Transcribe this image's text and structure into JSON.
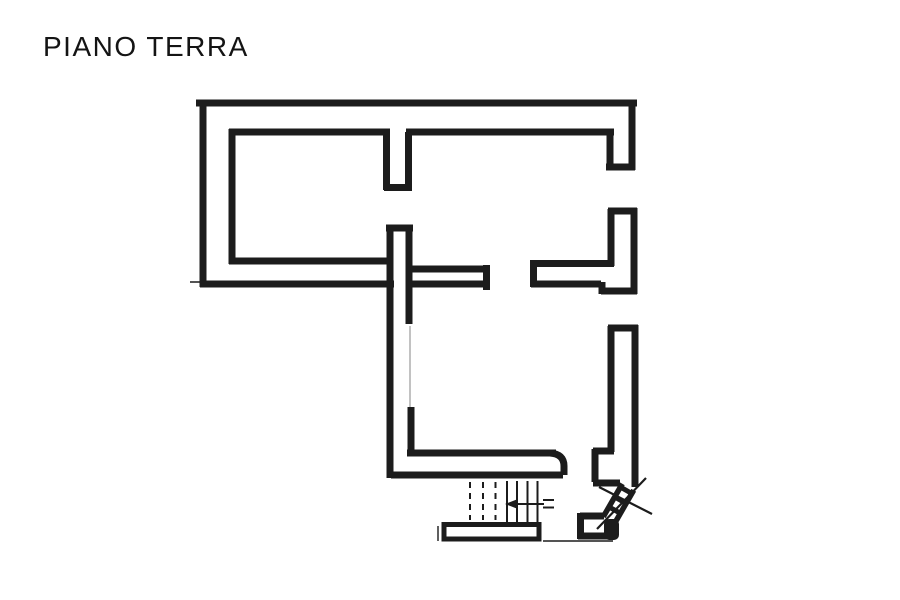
{
  "title": "PIANO TERRA",
  "colors": {
    "ink": "#1c1c1c",
    "paper": "#ffffff",
    "faint": "#b3b3b3"
  },
  "plan": {
    "wall_thickness": 7,
    "walls": [
      [
        196,
        103,
        637,
        103
      ],
      [
        203,
        100,
        203,
        287
      ],
      [
        200,
        284,
        394,
        284
      ],
      [
        632,
        100,
        632,
        170
      ],
      [
        606,
        167,
        635,
        167
      ],
      [
        610,
        129,
        610,
        170
      ],
      [
        229,
        132,
        390,
        132
      ],
      [
        232,
        129,
        232,
        264
      ],
      [
        229,
        261,
        391,
        261
      ],
      [
        406,
        132,
        614,
        132
      ],
      [
        386.5,
        132,
        386.5,
        190
      ],
      [
        408.5,
        132,
        408.5,
        190
      ],
      [
        384,
        187.5,
        412,
        187.5
      ],
      [
        386,
        228,
        413,
        228
      ],
      [
        390,
        228,
        390,
        478
      ],
      [
        409,
        228,
        409,
        324
      ],
      [
        411,
        407,
        411,
        455
      ],
      [
        411,
        269,
        488,
        269
      ],
      [
        409,
        284,
        488,
        284
      ],
      [
        486.5,
        265,
        486.5,
        290
      ],
      [
        533.5,
        260,
        533.5,
        287
      ],
      [
        531,
        263.5,
        614,
        263.5
      ],
      [
        531,
        284,
        601,
        284
      ],
      [
        602,
        282,
        602,
        294
      ],
      [
        608,
        211,
        637,
        211
      ],
      [
        611,
        209,
        611,
        266
      ],
      [
        634,
        208,
        634,
        294
      ],
      [
        601,
        291,
        637,
        291
      ],
      [
        608,
        328,
        638,
        328
      ],
      [
        611,
        326,
        611,
        452
      ],
      [
        635,
        325,
        635,
        487
      ],
      [
        593,
        451,
        614,
        451
      ],
      [
        595,
        449,
        595,
        482
      ],
      [
        593,
        483,
        620,
        483
      ],
      [
        407,
        453,
        556,
        453
      ],
      [
        391,
        475,
        563,
        475
      ],
      [
        580,
        516,
        604,
        516
      ],
      [
        580.5,
        513,
        580.5,
        539
      ],
      [
        578,
        536,
        614,
        536
      ]
    ],
    "wall_paths": [
      {
        "d": "M550,453 Q564,454 564,466 L564,475"
      }
    ],
    "thin_lines": [
      [
        190,
        282,
        245,
        282
      ],
      [
        438,
        526,
        438,
        541
      ],
      [
        543,
        541,
        613,
        541
      ]
    ],
    "faint_lines": [
      [
        410,
        326,
        410,
        407
      ]
    ],
    "stairs": {
      "tread_width": 2,
      "dash_pattern": "6 5",
      "dashed_treads": [
        [
          470,
          482,
          520
        ],
        [
          483,
          482,
          520
        ],
        [
          495.5,
          482,
          520
        ]
      ],
      "solid_treads": [
        [
          507,
          481,
          522
        ],
        [
          517,
          481,
          522
        ],
        [
          527.5,
          481,
          522
        ],
        [
          537.5,
          481,
          522
        ]
      ],
      "arrow": {
        "shaft": [
          516,
          504,
          544,
          504
        ],
        "head_points": "505,504 518,499 518,509",
        "tail_ticks": [
          [
            543,
            500,
            554,
            500
          ],
          [
            543,
            507.5,
            554,
            507.5
          ]
        ]
      },
      "landing": {
        "x": 444,
        "y": 524.5,
        "w": 95,
        "h": 14.5,
        "stroke_w": 5
      }
    },
    "diagonal_stair": {
      "edge_width": 5.5,
      "rung_width": 5,
      "cross_width": 2.2,
      "edges": [
        [
          622.3,
          483.8,
          603.3,
          516.8
        ],
        [
          633.7,
          490.2,
          614.7,
          523.2
        ]
      ],
      "rungs": [
        [
          620.4,
          487.1,
          631.8,
          493.5
        ],
        [
          614.7,
          497,
          626.1,
          503.4
        ],
        [
          609,
          506.9,
          620.4,
          513.3
        ]
      ],
      "cross": [
        [
          599,
          487,
          652,
          514
        ],
        [
          646,
          478,
          597,
          529
        ]
      ],
      "newel": {
        "x": 604,
        "y": 519,
        "w": 15,
        "h": 21,
        "rx": 5
      }
    }
  }
}
